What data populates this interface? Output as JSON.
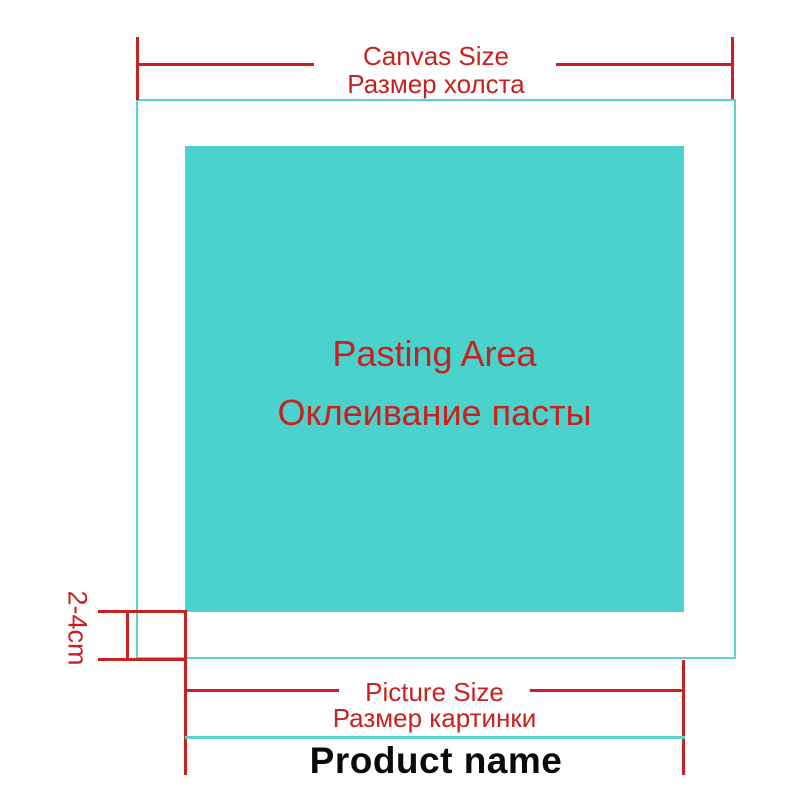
{
  "colors": {
    "teal_fill": "#4bd2cc",
    "teal_line": "#5cd3cf",
    "red": "#c92020",
    "ink": "#0b0b0b"
  },
  "canvas": {
    "dimension_label_en": "Canvas Size",
    "dimension_label_ru": "Размер холста"
  },
  "pasting_area": {
    "label_en": "Pasting Area",
    "label_ru": "Оклеивание пасты"
  },
  "margin": {
    "label": "2-4cm"
  },
  "picture": {
    "dimension_label_en": "Picture Size",
    "dimension_label_ru": "Размер картинки"
  },
  "product": {
    "name": "Product name"
  }
}
